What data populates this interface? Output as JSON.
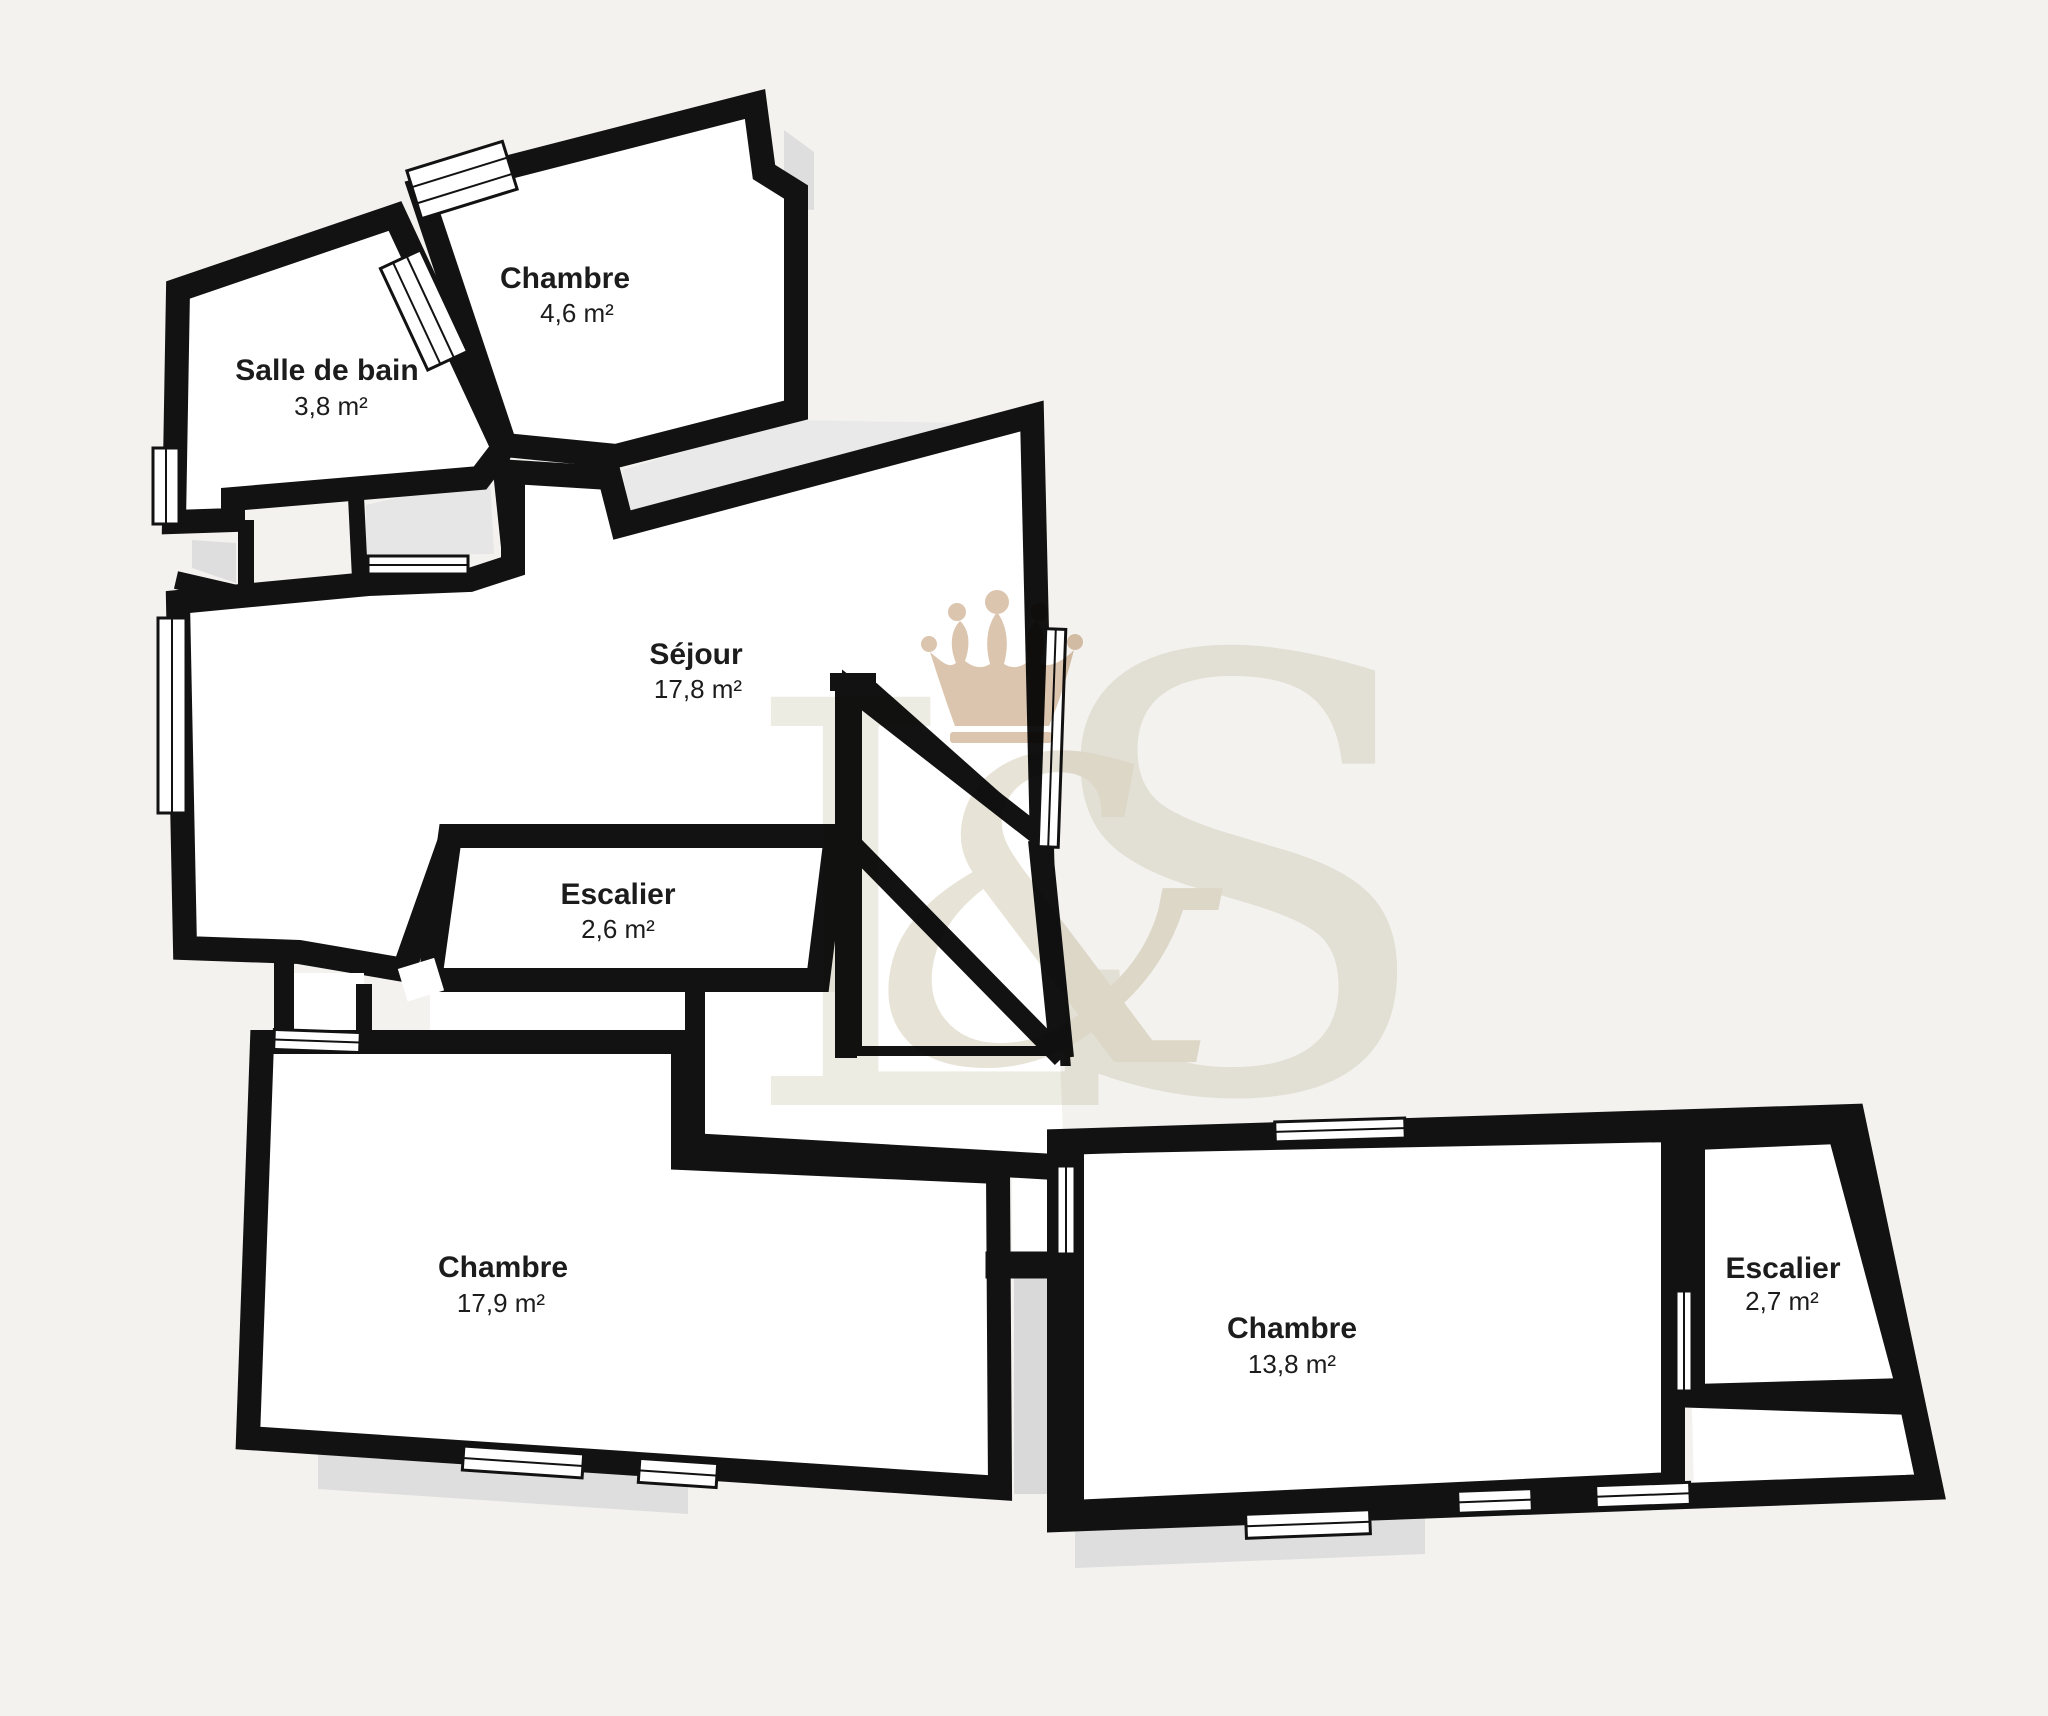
{
  "plan": {
    "type": "floor-plan",
    "rooms": [
      {
        "id": "salle-de-bain",
        "name": "Salle de bain",
        "area": "3,8 m²"
      },
      {
        "id": "chambre-haut",
        "name": "Chambre",
        "area": "4,6 m²"
      },
      {
        "id": "sejour",
        "name": "Séjour",
        "area": "17,8 m²"
      },
      {
        "id": "escalier-haut",
        "name": "Escalier",
        "area": "2,6 m²"
      },
      {
        "id": "chambre-gauche",
        "name": "Chambre",
        "area": "17,9 m²"
      },
      {
        "id": "chambre-droite",
        "name": "Chambre",
        "area": "13,8 m²"
      },
      {
        "id": "escalier-droit",
        "name": "Escalier",
        "area": "2,7 m²"
      }
    ],
    "watermark": {
      "letter_l": "L",
      "ampersand": "&",
      "letter_s": "S"
    },
    "colors": {
      "background": "#f4f2ef",
      "wall": "#121212",
      "room_fill": "#ffffff",
      "shadow": "#dcdcdc",
      "shadow_light": "#e9e9e9",
      "crown": "#dcc5ae",
      "monogram_light": "#edece3",
      "monogram_mid": "#e7e3d6",
      "label_text": "#1c1c1c"
    }
  }
}
